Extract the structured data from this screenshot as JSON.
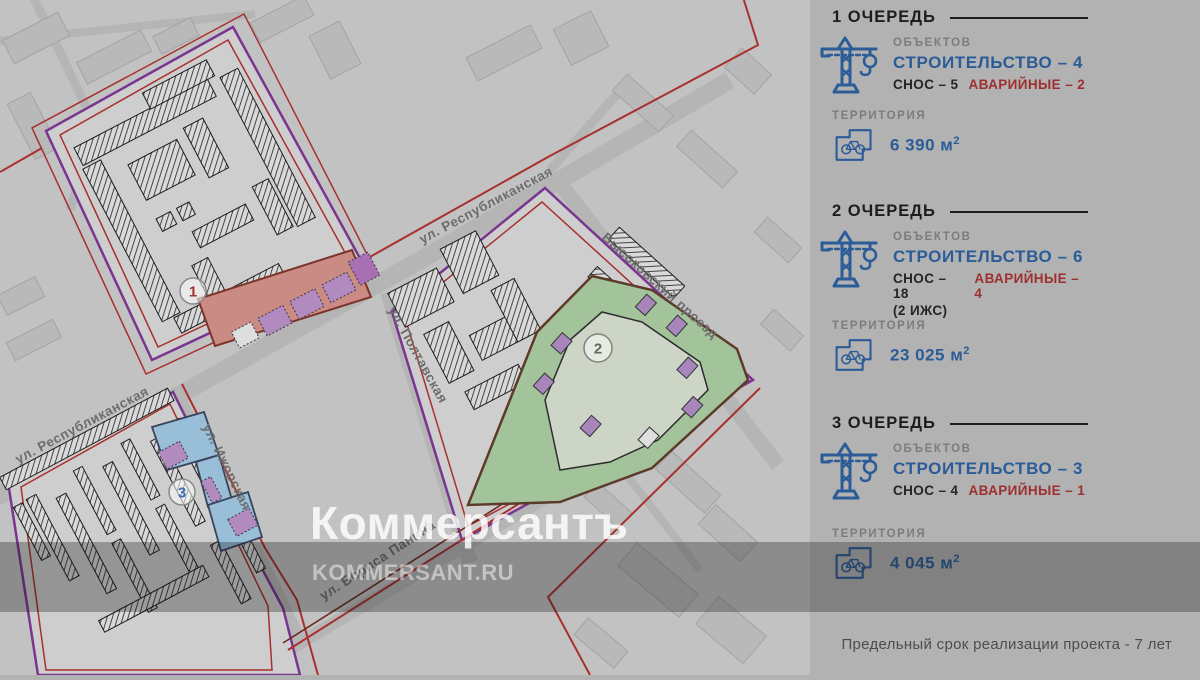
{
  "panel": {
    "sections": [
      {
        "title": "1 ОЧЕРЕДЬ",
        "objects_label": "ОБЪЕКТОВ",
        "construction": "СТРОИТЕЛЬСТВО – 4",
        "demolition": "СНОС – 5",
        "emergency": "АВАРИЙНЫЕ – 2",
        "note": "",
        "territory_label": "ТЕРРИТОРИЯ",
        "area": "6 390 м",
        "area_sup": "2"
      },
      {
        "title": "2 ОЧЕРЕДЬ",
        "objects_label": "ОБЪЕКТОВ",
        "construction": "СТРОИТЕЛЬСТВО – 6",
        "demolition": "СНОС – 18",
        "emergency": "АВАРИЙНЫЕ – 4",
        "note": "(2 ИЖС)",
        "territory_label": "ТЕРРИТОРИЯ",
        "area": "23 025 м",
        "area_sup": "2"
      },
      {
        "title": "3 ОЧЕРЕДЬ",
        "objects_label": "ОБЪЕКТОВ",
        "construction": "СТРОИТЕЛЬСТВО – 3",
        "demolition": "СНОС – 4",
        "emergency": "АВАРИЙНЫЕ – 1",
        "note": "",
        "territory_label": "ТЕРРИТОРИЯ",
        "area": "4 045 м",
        "area_sup": "2"
      }
    ],
    "footer_note": "Предельный срок реализации проекта - 7 лет"
  },
  "map": {
    "streets": {
      "republikanskaya_top": "ул. Республиканская",
      "republikanskaya_left": "ул. Республиканская",
      "poltavskaya": "ул. Полтавская",
      "vysokovsky": "Высоковский проезд",
      "izhorskaya": "ул. Ижорская",
      "borisa_panina": "ул. Бориса Панина"
    },
    "zones": [
      {
        "number": "1"
      },
      {
        "number": "2"
      },
      {
        "number": "3"
      }
    ]
  },
  "watermark": {
    "logo": "Коммерсантъ",
    "site": "KOMMERSANT.RU"
  },
  "colors": {
    "accent_blue": "#2b5c97",
    "accent_red": "#9e2f2f",
    "outline_purple": "#7a3590",
    "boundary_red": "#a8302e",
    "zone1_pink": "#c98b84",
    "zone2_green": "#a3c39b",
    "zone3_blue": "#98bed8",
    "panel_bg": "#b2b2b2",
    "map_bg": "#c2c2c2"
  }
}
